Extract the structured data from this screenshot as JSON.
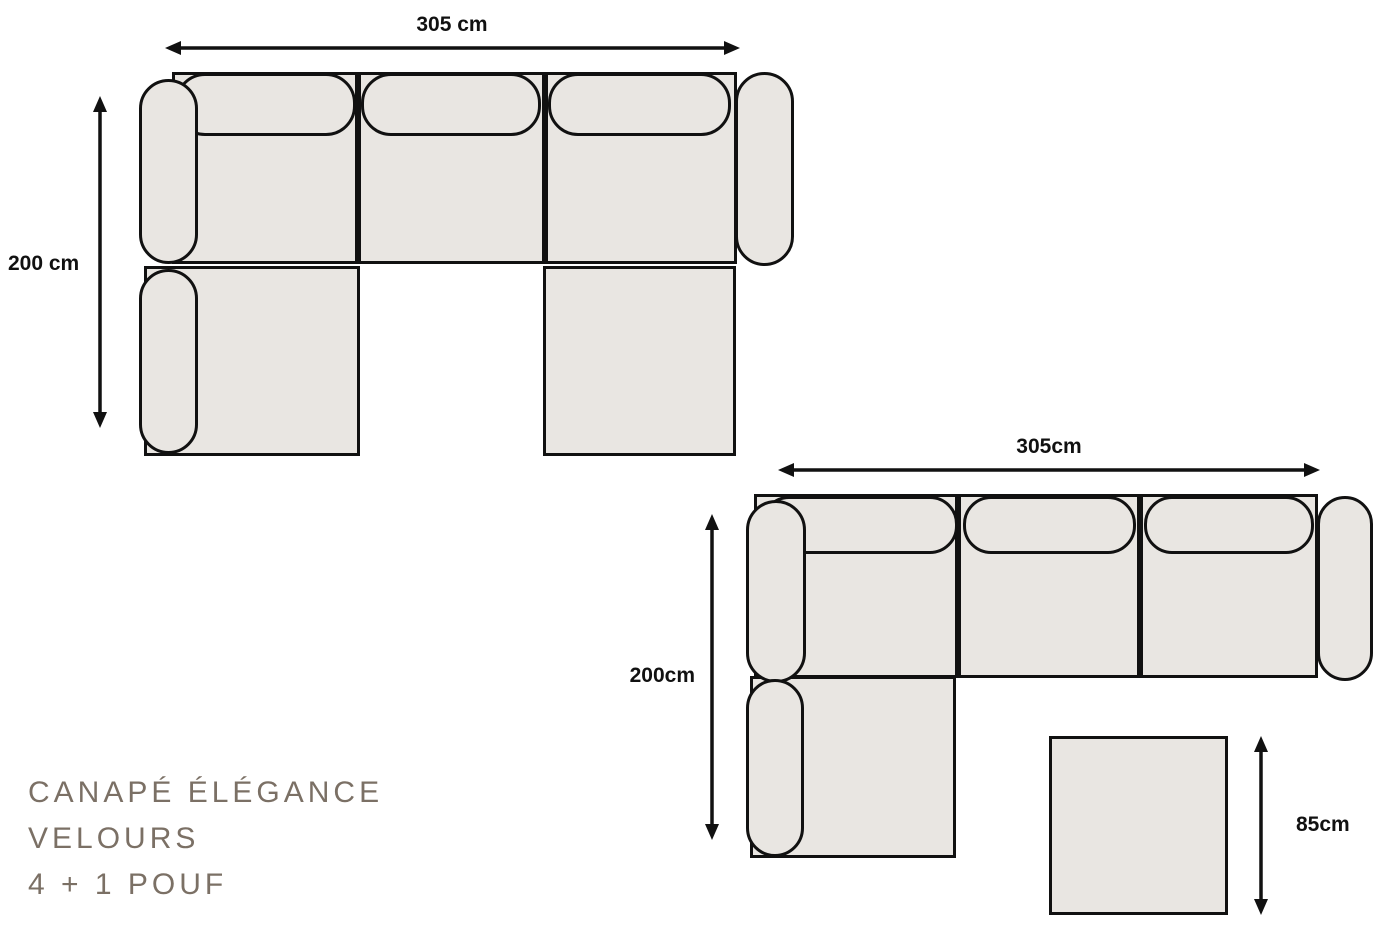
{
  "product": {
    "title_line1": "CANAPÉ ÉLÉGANCE",
    "title_line2": "VELOURS",
    "title_line3": "4 + 1 POUF"
  },
  "diagram_u_sofa": {
    "description": "u-shaped-sofa-top-view",
    "width_label": "305 cm",
    "depth_label": "200 cm"
  },
  "diagram_l_sofa": {
    "description": "l-shaped-sofa-top-view",
    "width_label": "305cm",
    "depth_label": "200cm"
  },
  "pouf": {
    "size_label": "85cm"
  },
  "colors": {
    "background": "#ffffff",
    "sofa_fill": "#e9e6e2",
    "outline": "#111111",
    "dimension_text": "#111111",
    "title_text": "#7b7065"
  }
}
